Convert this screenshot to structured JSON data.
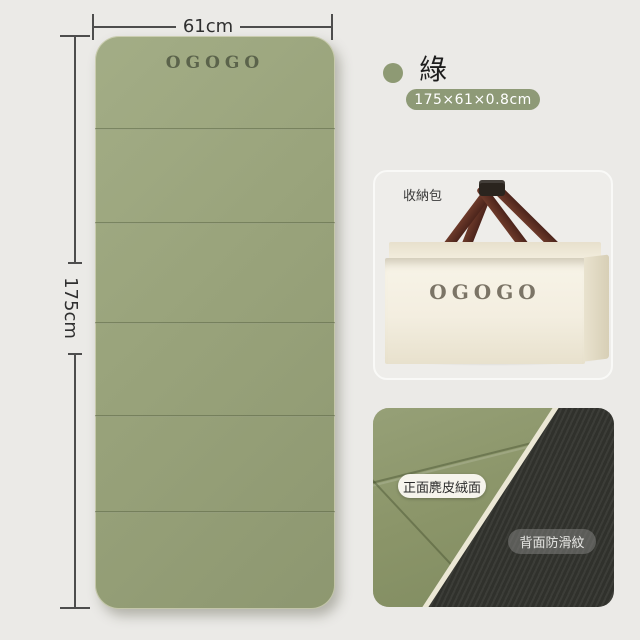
{
  "product_image": {
    "mat": {
      "brand": "OGOGO",
      "width_label": "61cm",
      "length_label": "175cm",
      "color_hex": "#99a37b",
      "panel_count": 6
    },
    "variant": {
      "name": "綠",
      "swatch_hex": "#8e9a74",
      "size_badge": "175×61×0.8cm",
      "badge_bg_hex": "#8e9a77"
    },
    "storage": {
      "label": "收納包",
      "bag_brand": "OGOGO",
      "bag_color_hex": "#f3eee0",
      "handle_color_hex": "#5d2d22"
    },
    "textures": {
      "front_label": "正面麂皮絨面",
      "back_label": "背面防滑紋",
      "front_color_hex": "#8b9569",
      "back_color_hex": "#30312c"
    }
  }
}
